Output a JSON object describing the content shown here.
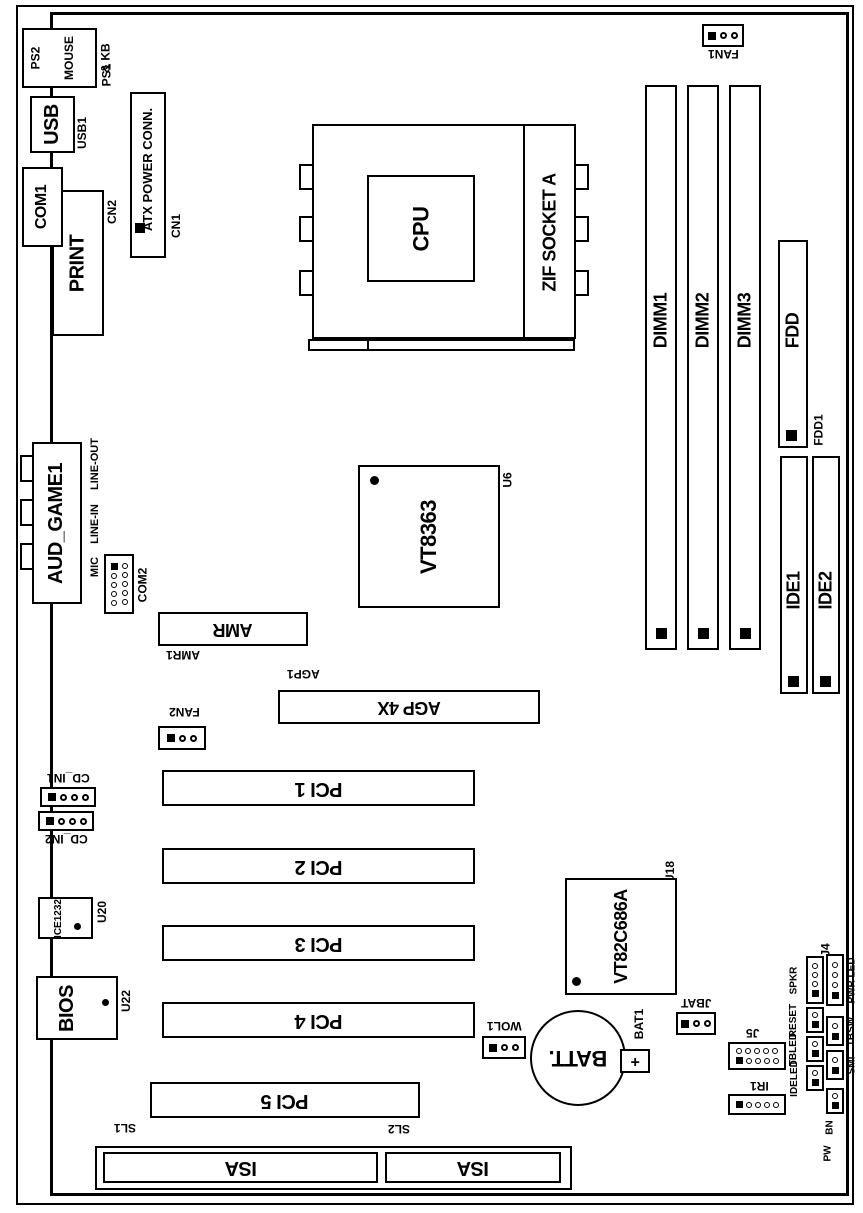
{
  "io_ports": {
    "ps2": {
      "lines": [
        "PS2",
        "MOUSE",
        "& KB"
      ],
      "ref": "PS1"
    },
    "usb": {
      "label": "USB",
      "ref": "USB1"
    },
    "com1": {
      "label": "COM1"
    },
    "print": {
      "label": "PRINT"
    },
    "audio_game": {
      "label": "AUD_GAME1"
    },
    "jacks": [
      "LINE-OUT",
      "LINE-IN",
      "MIC"
    ],
    "com2": {
      "label": "COM2"
    }
  },
  "power": {
    "atx": {
      "label": "ATX POWER CONN.",
      "ref": "CN1"
    },
    "cn2": "CN2"
  },
  "cpu": {
    "label": "CPU",
    "socket": "ZIF SOCKET A"
  },
  "memory": {
    "dimms": [
      "DIMM1",
      "DIMM2",
      "DIMM3"
    ]
  },
  "chips": {
    "northbridge": {
      "label": "VT8363",
      "ref": "U6"
    },
    "southbridge": {
      "label": "VT82C686A",
      "ref": "U18"
    },
    "monitor_ic": {
      "label": "ICE1232",
      "ref": "U20"
    },
    "bios": {
      "label": "BIOS",
      "ref": "U22"
    }
  },
  "storage": {
    "fdd": {
      "label": "FDD",
      "ref": "FDD1"
    },
    "ide1": {
      "label": "IDE1"
    },
    "ide2": {
      "label": "IDE2"
    }
  },
  "slots": {
    "amr": {
      "label": "AMR",
      "ref": "AMR1"
    },
    "agp": {
      "label": "AGP 4X",
      "ref": "AGP1"
    },
    "pci": [
      "PCI 1",
      "PCI 2",
      "PCI 3",
      "PCI 4",
      "PCI 5"
    ],
    "isa": {
      "labels": [
        "ISA",
        "ISA"
      ],
      "refs": [
        "SL1",
        "SL2"
      ]
    }
  },
  "fans": {
    "fan1": "FAN1",
    "fan2": "FAN2"
  },
  "headers": {
    "cd_in1": "CD_IN1",
    "cd_in2": "CD_IN2",
    "wol": "WOL1",
    "battery": {
      "label": "BATT.",
      "plus": "+",
      "ref": "BAT1"
    },
    "jbat": "JBAT",
    "j5": "J5",
    "ir1": "IR1",
    "j4": {
      "label": "J4",
      "left": [
        "SPKR",
        "RESET",
        "TBLED",
        "IDELED"
      ],
      "right": [
        "PWR LED",
        "TBSW",
        "SMI"
      ],
      "bottom": [
        "BN",
        "PW"
      ]
    }
  }
}
